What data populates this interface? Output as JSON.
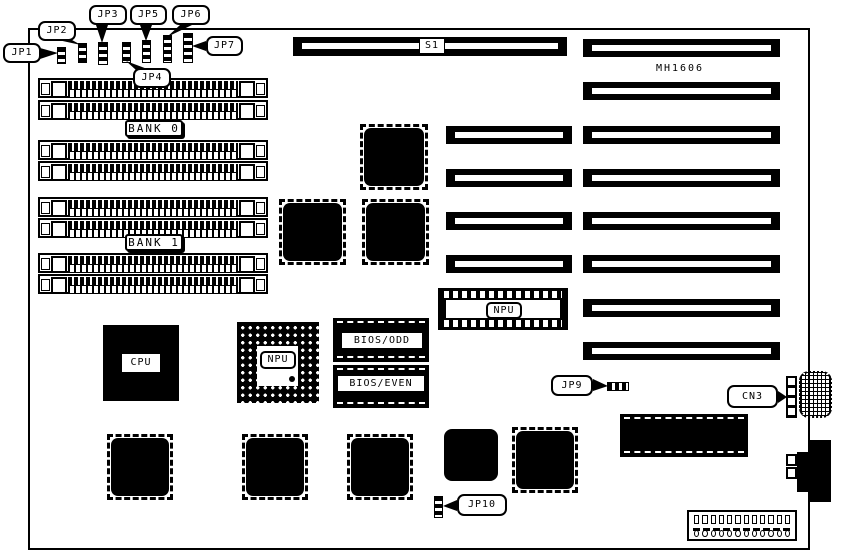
{
  "board": {
    "model": "MH1606",
    "type": "system-board component location diagram",
    "colors": {
      "ink": "#000000",
      "paper": "#ffffff"
    }
  },
  "labels": {
    "s1": "S1",
    "model": "MH1606",
    "bank0": "BANK 0",
    "bank1": "BANK 1",
    "cpu": "CPU",
    "npu_pga": "NPU",
    "npu_dip": "NPU",
    "bios_odd": "BIOS/ODD",
    "bios_even": "BIOS/EVEN",
    "jp1": "JP1",
    "jp2": "JP2",
    "jp3": "JP3",
    "jp4": "JP4",
    "jp5": "JP5",
    "jp6": "JP6",
    "jp7": "JP7",
    "jp9": "JP9",
    "jp10": "JP10",
    "cn3": "CN3"
  },
  "inventory": {
    "simm_sockets": 8,
    "long_slots": 8,
    "short_slots": 4,
    "qfp_chips": 7,
    "jumpers": [
      "JP1",
      "JP2",
      "JP3",
      "JP4",
      "JP5",
      "JP6",
      "JP7",
      "JP9",
      "JP10"
    ],
    "connectors": [
      "CN3"
    ]
  }
}
